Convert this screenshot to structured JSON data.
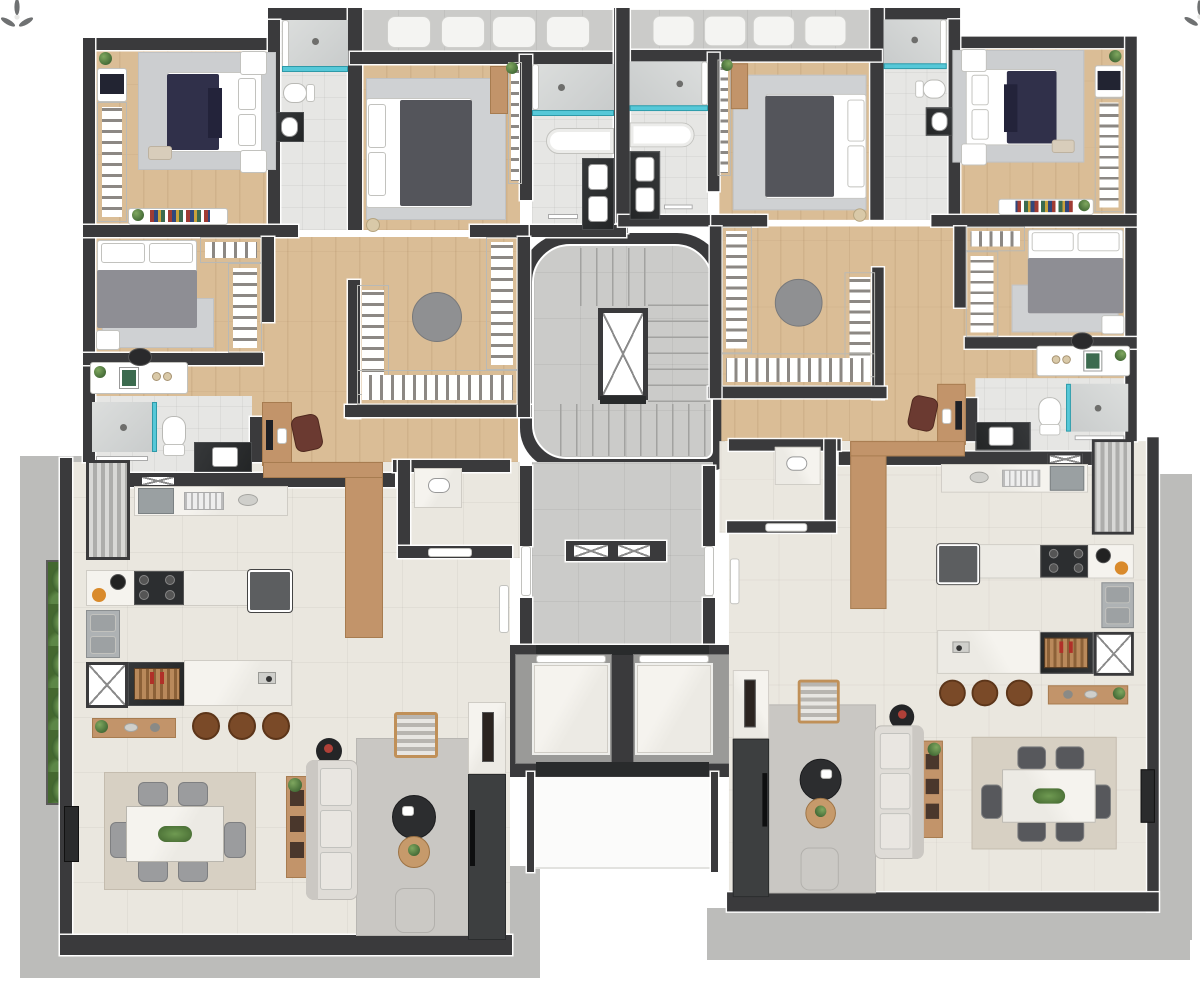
{
  "title": "residential-floor-plan-top-view",
  "palette": {
    "wall": "#3a3a3c",
    "wall-dark": "#292b2c",
    "wood-floor": "#dabd96",
    "cream-tile": "#eae7df",
    "gray-tile": "#cbcbc9",
    "bath-tile": "#e6e6e4",
    "shower-glass-teal": "#56c8d8",
    "marble-light": "#f3f1ec",
    "marble-dark": "#2f3133",
    "wood-furniture": "#c2946a",
    "terrace-concrete": "#bcbcba",
    "planter-green": "#5d8747",
    "sofa": "#dfdcd7",
    "rug-gray": "#c9c7c3",
    "rug-beige": "#d7d0c3",
    "bed-navy": "#30304a",
    "bed-charcoal": "#54555b",
    "stool-brown": "#7a4a28"
  },
  "core": {
    "rooms": [
      "staircase",
      "stair-shaft",
      "landing-hall",
      "elevator-1",
      "elevator-2",
      "elevator-lobby"
    ],
    "shaft_count": 5,
    "elevator_count": 2
  },
  "apartments": [
    {
      "id": "left",
      "mirrored": false,
      "rooms": [
        "bedroom-1",
        "bathroom-1",
        "master-bedroom",
        "master-bathroom",
        "walk-in-closet",
        "bedroom-3",
        "bathroom-2",
        "home-office",
        "hallway",
        "entry-gallery",
        "powder-room",
        "kitchen",
        "barbecue-area",
        "private-elevator",
        "service-area",
        "dining-room",
        "living-room",
        "balcony"
      ],
      "furniture": [
        "double-bed-navy",
        "double-bed-charcoal",
        "single-bed-gray",
        "u-shaped-wardrobe",
        "round-pouf",
        "office-desk-chair",
        "kitchen-island-3-stools",
        "gas-cooktop",
        "fridge",
        "bbq-grill",
        "dining-table-6-chairs",
        "sofa",
        "coffee-tables",
        "media-wall-tv",
        "ceiling-fan",
        "deck-chair"
      ]
    },
    {
      "id": "right",
      "mirrored": true,
      "rooms": [
        "bedroom-1",
        "bathroom-1",
        "master-bedroom",
        "master-bathroom",
        "walk-in-closet",
        "bedroom-3",
        "bathroom-2",
        "home-office",
        "hallway",
        "entry-gallery",
        "powder-room",
        "kitchen",
        "barbecue-area",
        "private-elevator",
        "service-area",
        "dining-room",
        "living-room",
        "balcony"
      ],
      "furniture": [
        "double-bed-green",
        "double-bed-brown",
        "single-bed-mauve",
        "u-shaped-wardrobe",
        "round-pouf",
        "office-desk-chair",
        "kitchen-island-3-stools",
        "gas-cooktop",
        "fridge",
        "bbq-grill",
        "dining-table-6-chairs",
        "sofa",
        "coffee-tables",
        "media-wall-tv",
        "ceiling-fan"
      ]
    }
  ],
  "exterior": {
    "features": [
      "terrace-walkway-left",
      "terrace-walkway-bottom",
      "terrace-walkway-right",
      "hedge-planter",
      "balcony-sun-loungers"
    ],
    "sun_lounger_count": 8
  }
}
